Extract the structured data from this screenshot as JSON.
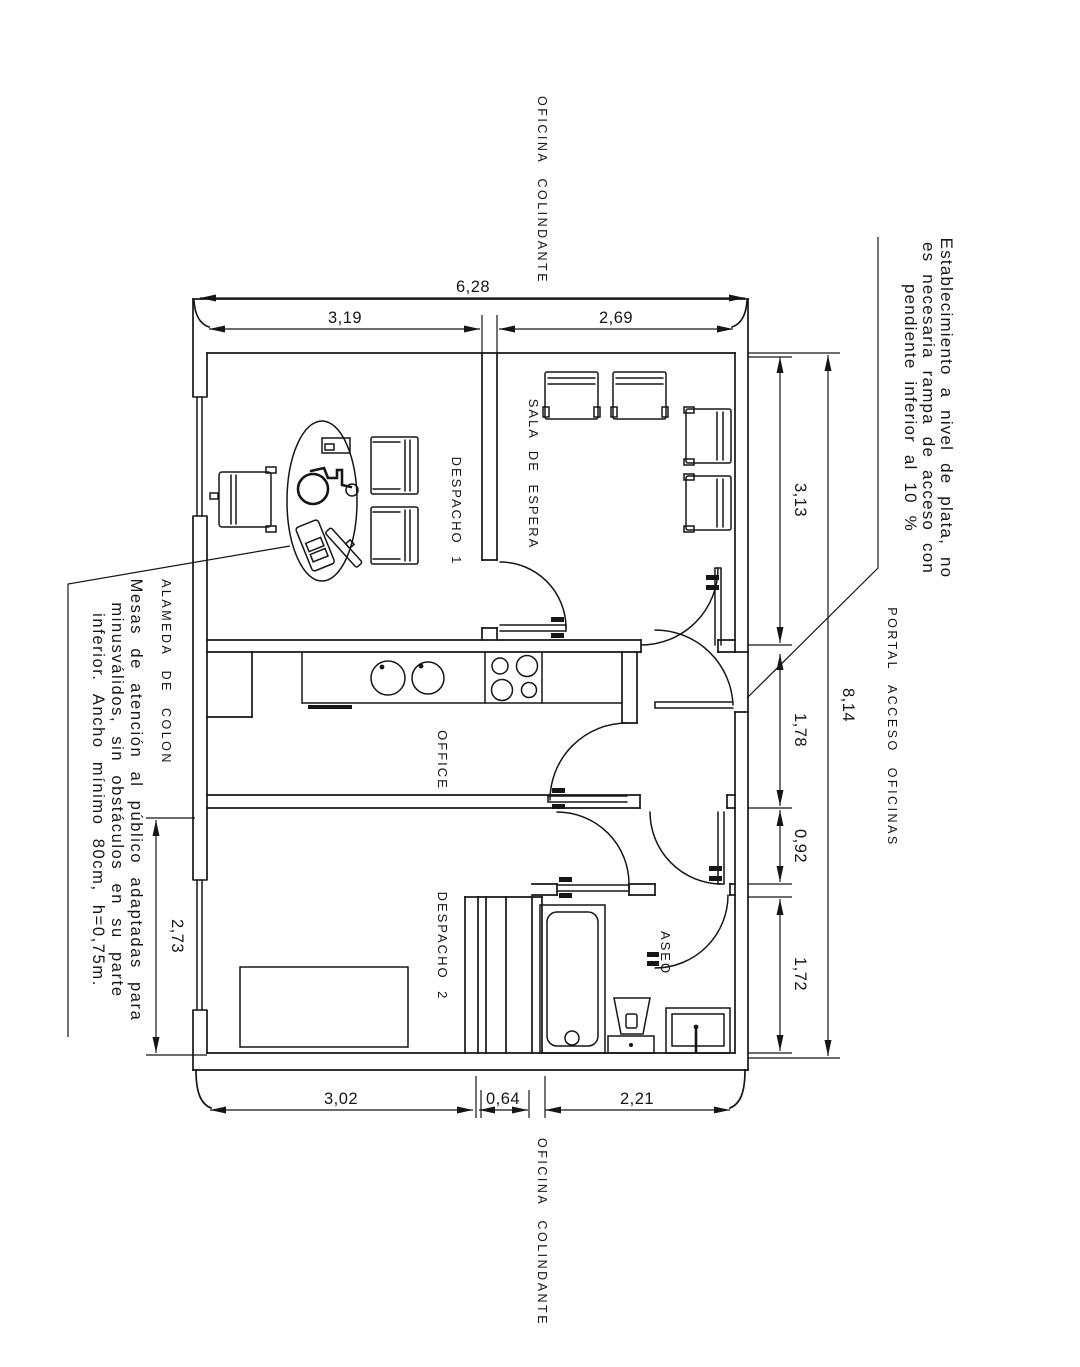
{
  "style": {
    "ink": "#161616",
    "paper": "#ffffff"
  },
  "surround": {
    "top": "OFICINA COLINDANTE",
    "bottom": "OFICINA COLINDANTE",
    "left": "ALAMEDA DE COLON",
    "right": "PORTAL ACCESO OFICINAS"
  },
  "rooms": {
    "despacho1": "DESPACHO 1",
    "sala": "SALA DE ESPERA",
    "office": "OFFICE",
    "despacho2": "DESPACHO 2",
    "aseo": "ASEO"
  },
  "dims": {
    "total_width": "6,28",
    "despacho1_width": "3,19",
    "sala_width": "2,69",
    "sala_height": "3,13",
    "hall_height": "1,78",
    "vestibule_height": "0,92",
    "aseo_height": "1,72",
    "total_height": "8,14",
    "despacho2_height": "2,73",
    "despacho2_width": "3,02",
    "closet_width": "0,64",
    "aseo_width": "2,21"
  },
  "notes": {
    "access": {
      "line1": "Establecimiento a nivel de plata, no",
      "line2": "es necesaria rampa de acceso con",
      "line3": "pendiente inferior al 10 %"
    },
    "desk": {
      "line1": "Mesas de atención al público adaptadas para",
      "line2": "minusválidos, sin obstáculos en su parte",
      "line3": "inferior. Ancho mínimo 80cm, h=0,75m."
    }
  }
}
